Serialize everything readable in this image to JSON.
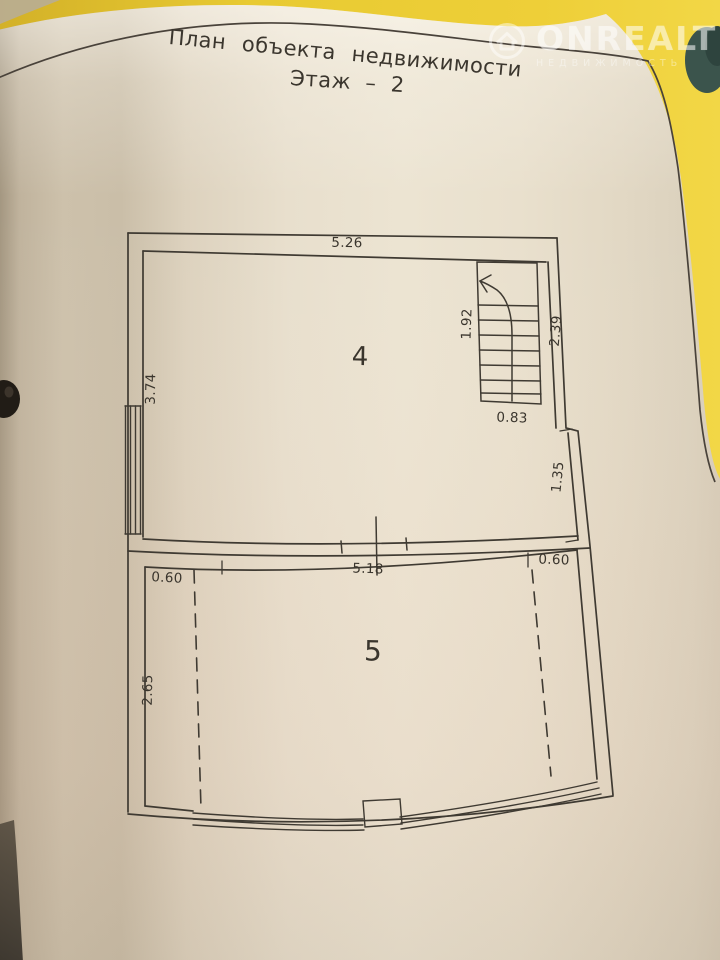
{
  "page": {
    "title": "План объекта недвижимости",
    "subtitle": "Этаж – 2"
  },
  "watermark": {
    "brand": "ONREALT",
    "tagline": "НЕДВИЖИМОСТЬ"
  },
  "plan": {
    "room4_label": "4",
    "room5_label": "5",
    "dims": {
      "room4_top_width": "5.26",
      "room4_left_height": "3.74",
      "stair_length": "1.92",
      "stair_right_height": "2.39",
      "stair_width": "0.83",
      "right_wall_lower": "1.35",
      "room5_top_width": "5.18",
      "room5_left_offset": "0.60",
      "room5_right_offset": "0.60",
      "room5_left_height": "2.65"
    }
  },
  "colors": {
    "background_yellow": "#e6c32f",
    "paper": "#e7decd",
    "ink": "#3a352d",
    "plan_line": "#3f3a32",
    "teal_patch": "#3b544c"
  }
}
